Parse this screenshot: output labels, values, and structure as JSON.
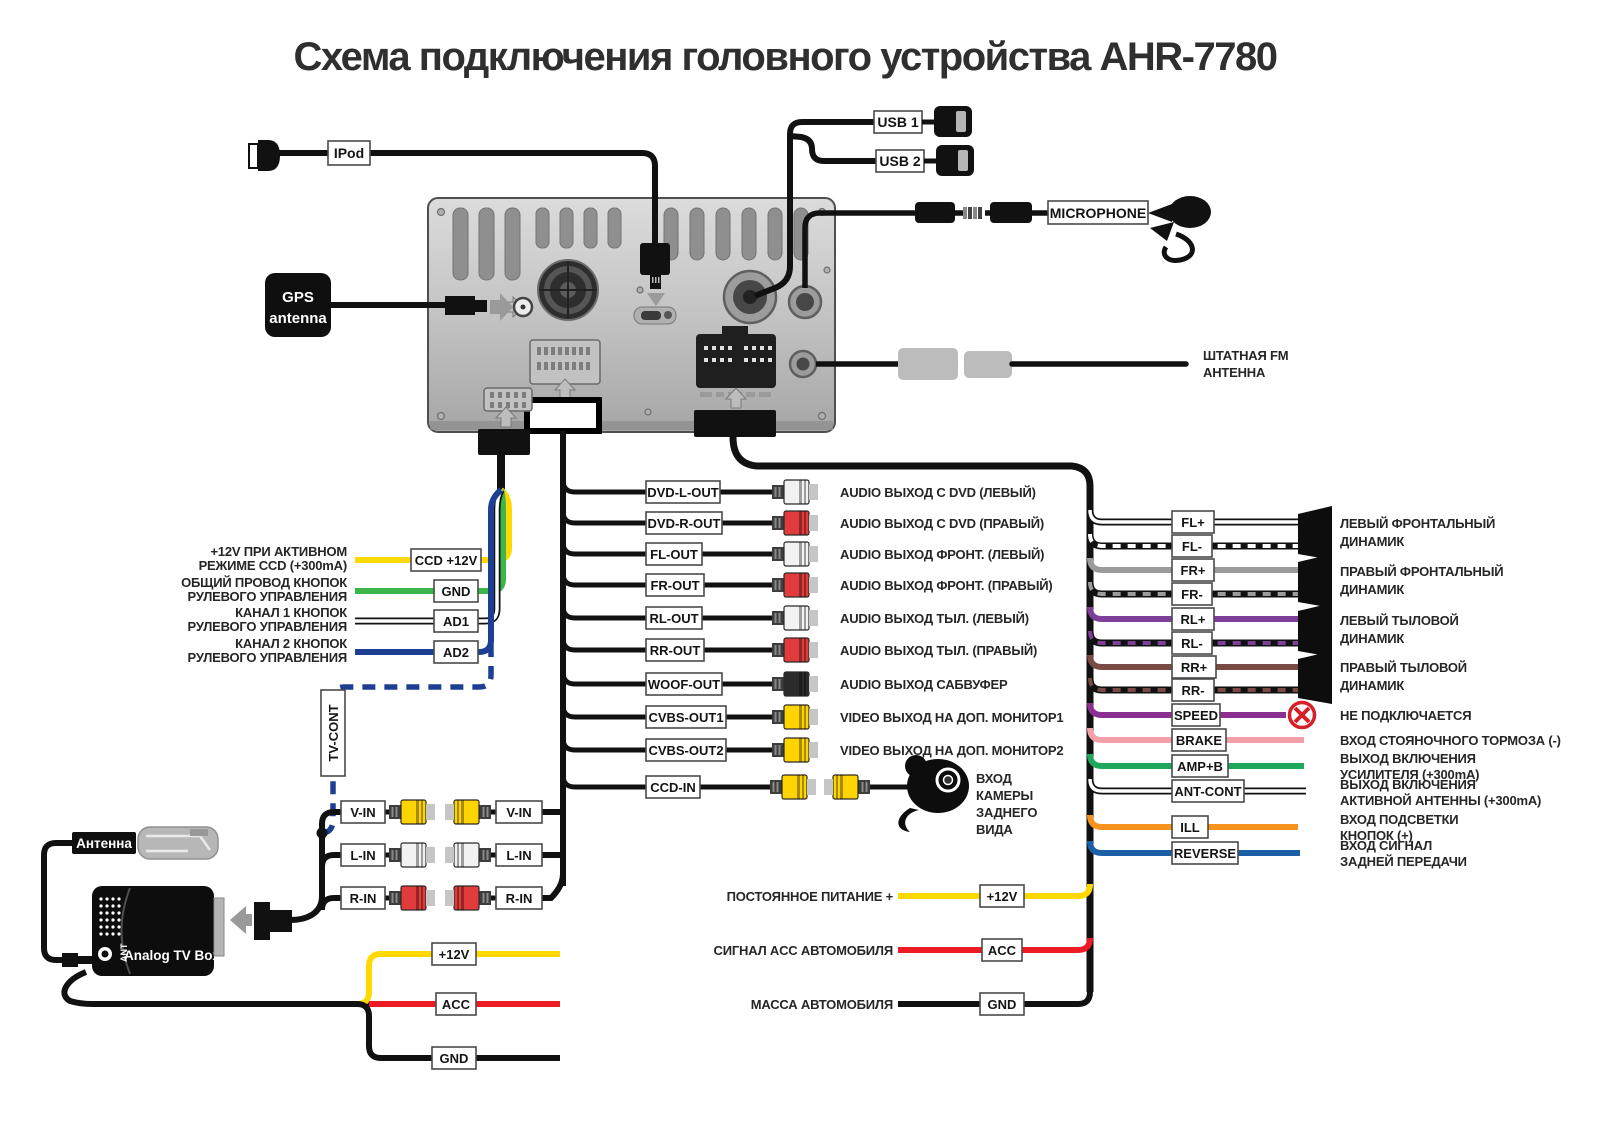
{
  "title": "Схема подключения головного устройства AHR-7780",
  "unit": {
    "ipod": "IPod",
    "usb1": "USB 1",
    "usb2": "USB 2",
    "mic": "MICROPHONE",
    "gps1": "GPS",
    "gps2": "antenna",
    "fm1": "ШТАТНАЯ FM",
    "fm2": "АНТЕННА"
  },
  "steering": [
    {
      "d1": "+12V ПРИ АКТИВНОМ",
      "d2": "РЕЖИМЕ CCD (+300mA)",
      "tag": "CCD +12V",
      "color": "#ffd800"
    },
    {
      "d1": "ОБЩИЙ ПРОВОД КНОПОК",
      "d2": "РУЛЕВОГО УПРАВЛЕНИЯ",
      "tag": "GND",
      "color": "#3cb54a"
    },
    {
      "d1": "КАНАЛ 1 КНОПОК",
      "d2": "РУЛЕВОГО УПРАВЛЕНИЯ",
      "tag": "AD1",
      "color": "#ffffff"
    },
    {
      "d1": "КАНАЛ 2 КНОПОК",
      "d2": "РУЛЕВОГО УПРАВЛЕНИЯ",
      "tag": "AD2",
      "color": "#1c3f94"
    }
  ],
  "tvcont": "TV-CONT",
  "av_out": [
    {
      "tag": "DVD-L-OUT",
      "desc": "AUDIO ВЫХОД С DVD (ЛЕВЫЙ)",
      "color": "#f2f2f2"
    },
    {
      "tag": "DVD-R-OUT",
      "desc": "AUDIO ВЫХОД С DVD (ПРАВЫЙ)",
      "color": "#e23b3b"
    },
    {
      "tag": "FL-OUT",
      "desc": "AUDIO ВЫХОД ФРОНТ. (ЛЕВЫЙ)",
      "color": "#f2f2f2"
    },
    {
      "tag": "FR-OUT",
      "desc": "AUDIO ВЫХОД ФРОНТ. (ПРАВЫЙ)",
      "color": "#e23b3b"
    },
    {
      "tag": "RL-OUT",
      "desc": "AUDIO ВЫХОД ТЫЛ. (ЛЕВЫЙ)",
      "color": "#f2f2f2"
    },
    {
      "tag": "RR-OUT",
      "desc": "AUDIO ВЫХОД ТЫЛ. (ПРАВЫЙ)",
      "color": "#e23b3b"
    },
    {
      "tag": "WOOF-OUT",
      "desc": "AUDIO ВЫХОД САБВУФЕР",
      "color": "#2b2b2b"
    },
    {
      "tag": "CVBS-OUT1",
      "desc": "VIDEO ВЫХОД НА ДОП. МОНИТОР1",
      "color": "#ffd400"
    },
    {
      "tag": "CVBS-OUT2",
      "desc": "VIDEO ВЫХОД НА ДОП. МОНИТОР2",
      "color": "#ffd400"
    }
  ],
  "ccd_in": {
    "tag": "CCD-IN",
    "l1": "ВХОД",
    "l2": "КАМЕРЫ",
    "l3": "ЗАДНЕГО",
    "l4": "ВИДА",
    "color": "#ffd400"
  },
  "speakers": {
    "wires": [
      {
        "tag": "FL+",
        "color": "#ffffff",
        "striped": false
      },
      {
        "tag": "FL-",
        "color": "#ffffff",
        "striped": true
      },
      {
        "tag": "FR+",
        "color": "#9b9b9b",
        "striped": false
      },
      {
        "tag": "FR-",
        "color": "#9b9b9b",
        "striped": true
      },
      {
        "tag": "RL+",
        "color": "#7d3f98",
        "striped": false
      },
      {
        "tag": "RL-",
        "color": "#7d3f98",
        "striped": true
      },
      {
        "tag": "RR+",
        "color": "#7a4a45",
        "striped": false
      },
      {
        "tag": "RR-",
        "color": "#7a4a45",
        "striped": true
      }
    ],
    "groups": [
      {
        "l1": "ЛЕВЫЙ ФРОНТАЛЬНЫЙ",
        "l2": "ДИНАМИК"
      },
      {
        "l1": "ПРАВЫЙ ФРОНТАЛЬНЫЙ",
        "l2": "ДИНАМИК"
      },
      {
        "l1": "ЛЕВЫЙ ТЫЛОВОЙ",
        "l2": "ДИНАМИК"
      },
      {
        "l1": "ПРАВЫЙ ТЫЛОВОЙ",
        "l2": "ДИНАМИК"
      }
    ]
  },
  "controls": [
    {
      "tag": "SPEED",
      "d1": "НЕ ПОДКЛЮЧАЕТСЯ",
      "d2": "",
      "color": "#8b3090"
    },
    {
      "tag": "BRAKE",
      "d1": "ВХОД СТОЯНОЧНОГО ТОРМОЗА (-)",
      "d2": "",
      "color": "#f4a0a8"
    },
    {
      "tag": "AMP+B",
      "d1": "ВЫХОД ВКЛЮЧЕНИЯ",
      "d2": "УСИЛИТЕЛЯ (+300mA)",
      "color": "#1fa85c"
    },
    {
      "tag": "ANT-CONT",
      "d1": "ВЫХОД ВКЛЮЧЕНИЯ",
      "d2": "АКТИВНОЙ АНТЕННЫ (+300mA)",
      "color": "#ffffff"
    },
    {
      "tag": "ILL",
      "d1": "ВХОД ПОДСВЕТКИ",
      "d2": "КНОПОК (+)",
      "color": "#f6921e"
    },
    {
      "tag": "REVERSE",
      "d1": "ВХОД СИГНАЛ",
      "d2": "ЗАДНЕЙ ПЕРЕДАЧИ",
      "color": "#1b5fa8"
    }
  ],
  "main_power": [
    {
      "desc": "ПОСТОЯННОЕ ПИТАНИЕ +",
      "tag": "+12V",
      "color": "#ffd800"
    },
    {
      "desc": "СИГНАЛ ACC АВТОМОБИЛЯ",
      "tag": "ACC",
      "color": "#ed1c24"
    },
    {
      "desc": "МАССА АВТОМОБИЛЯ",
      "tag": "GND",
      "color": "#111111"
    }
  ],
  "tv": {
    "antenna": "Антенна",
    "name": "Analog TV Box",
    "ant": "ANT",
    "in": [
      "V-IN",
      "L-IN",
      "R-IN"
    ],
    "in_colors": [
      "#ffd400",
      "#f2f2f2",
      "#e23b3b"
    ],
    "power": [
      "+12V",
      "ACC",
      "GND"
    ],
    "power_colors": [
      "#ffd800",
      "#ed1c24",
      "#111111"
    ]
  }
}
